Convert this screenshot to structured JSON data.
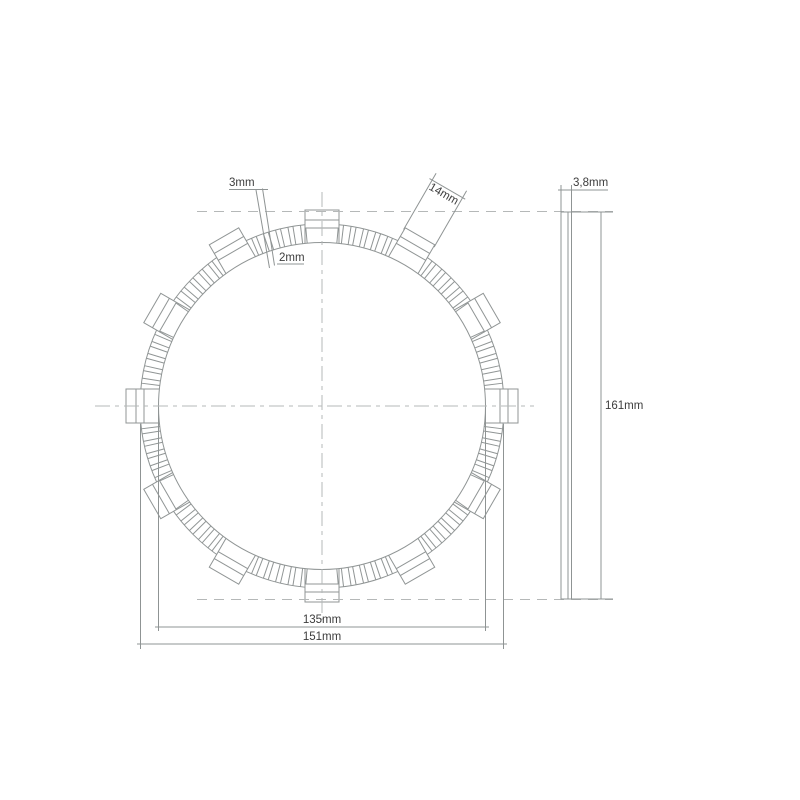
{
  "page": {
    "background": "#ffffff",
    "title": "clutch friction plate dimension drawing"
  },
  "drawing": {
    "type": "technical-drawing",
    "subject": "clutch friction disc - front view and side view with dimensions",
    "colors": {
      "line": "#909595",
      "centerline": "#b5b8b8",
      "text": "#3c3c3c",
      "background": "#ffffff"
    },
    "front_view": {
      "labels": {
        "groove_width_outer": "3mm",
        "groove_width_inner": "2mm",
        "tab_width": "14mm",
        "friction_inner_diameter": "135mm",
        "friction_outer_diameter": "151mm"
      },
      "values_mm": {
        "groove_width_outer": 3,
        "groove_width_inner": 2,
        "tab_width": 14,
        "friction_inner_diameter": 135,
        "friction_outer_diameter": 151
      },
      "geometry": {
        "center_x": 322,
        "center_y": 406,
        "inner_radius_px": 163.5,
        "outer_radius_px": 182,
        "tab_outer_radius_px": 196,
        "tab_base_radius_px": 178,
        "tab_band_radius_px": 186,
        "tab_count": 12,
        "tab_step_deg": 30,
        "tab_half_width_px": 17,
        "groove_pitch_deg": 4,
        "groove_half_width_deg": 0.8,
        "groove_offset_deg": 2,
        "groove_tab_clearance_deg": 5.6
      }
    },
    "side_view": {
      "labels": {
        "thickness": "3,8mm",
        "overall_diameter": "161mm"
      },
      "values_mm": {
        "thickness": 3.8,
        "overall_diameter": 161
      },
      "geometry": {
        "bar_left_px": 561,
        "bar_right_px": 571.5,
        "core_line_px": 568,
        "bar_top_px": 212,
        "bar_bottom_px": 599
      }
    }
  }
}
